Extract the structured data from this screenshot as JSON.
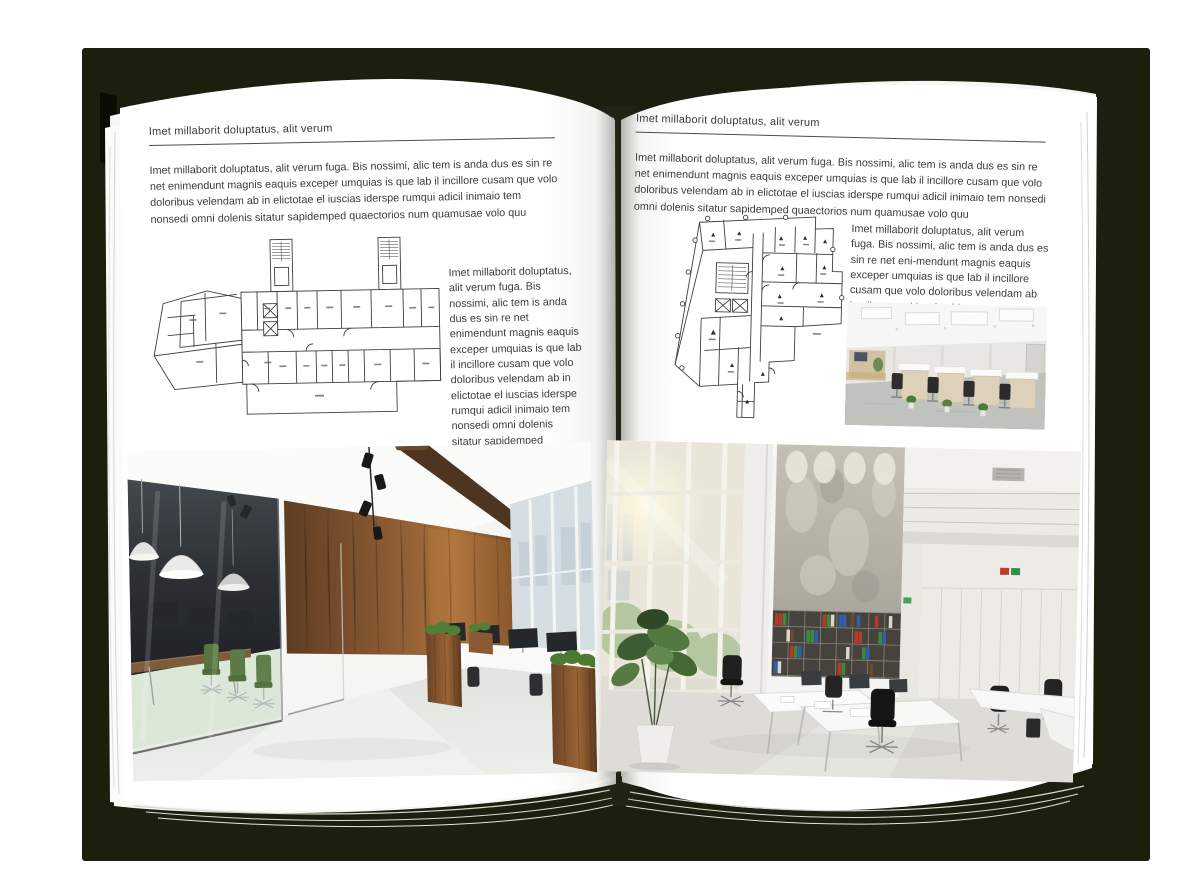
{
  "colors": {
    "backdrop": "#1c1f0e",
    "page": "#ffffff",
    "rule": "#4c4c4c",
    "body_text": "#3c3c3c",
    "plan_line": "#3f3f3f",
    "wood_wall": "#7a5230",
    "chair_green": "#4c6b33"
  },
  "left_page": {
    "header": "Imet millaborit doluptatus, alit verum",
    "intro": "Imet millaborit doluptatus, alit verum fuga. Bis nossimi, alic tem is anda dus es sin re net enimendunt magnis eaquis exceper umquias is que lab il incillore cusam que volo doloribus velendam ab in elictotae el iuscias iderspe rumqui adicil inimaio tem nonsedi omni dolenis sitatur sapidemped quaectorios num quamusae volo quu",
    "side_text": "Imet millaborit doluptatus, alit verum fuga. Bis nossimi, alic tem is anda dus es sin re net enimendunt magnis eaquis exceper umquias is que lab il incillore cusam que volo doloribus velendam ab in elictotae el iuscias iderspe rumqui adicil inimaio tem nonsedi omni dolenis sitatur sapidemped quaectorios num quamusae volo quu"
  },
  "right_page": {
    "header": "Imet millaborit doluptatus, alit verum",
    "intro": "Imet millaborit doluptatus, alit verum fuga. Bis nossimi, alic tem is anda dus es sin re net enimendunt magnis eaquis exceper umquias is que lab il incillore cusam que volo doloribus velendam ab in elictotae el iuscias iderspe rumqui adicil inimaio tem nonsedi omni dolenis sitatur sapidemped quaectorios num quamusae volo quu",
    "side_text": "Imet millaborit doluptatus, alit verum fuga. Bis nossimi, alic tem is anda dus es sin re net eni-mendunt magnis eaquis exceper umquias is que lab il incillore cusam que volo doloribus velendam ab in elictotae el iuscias iders"
  }
}
